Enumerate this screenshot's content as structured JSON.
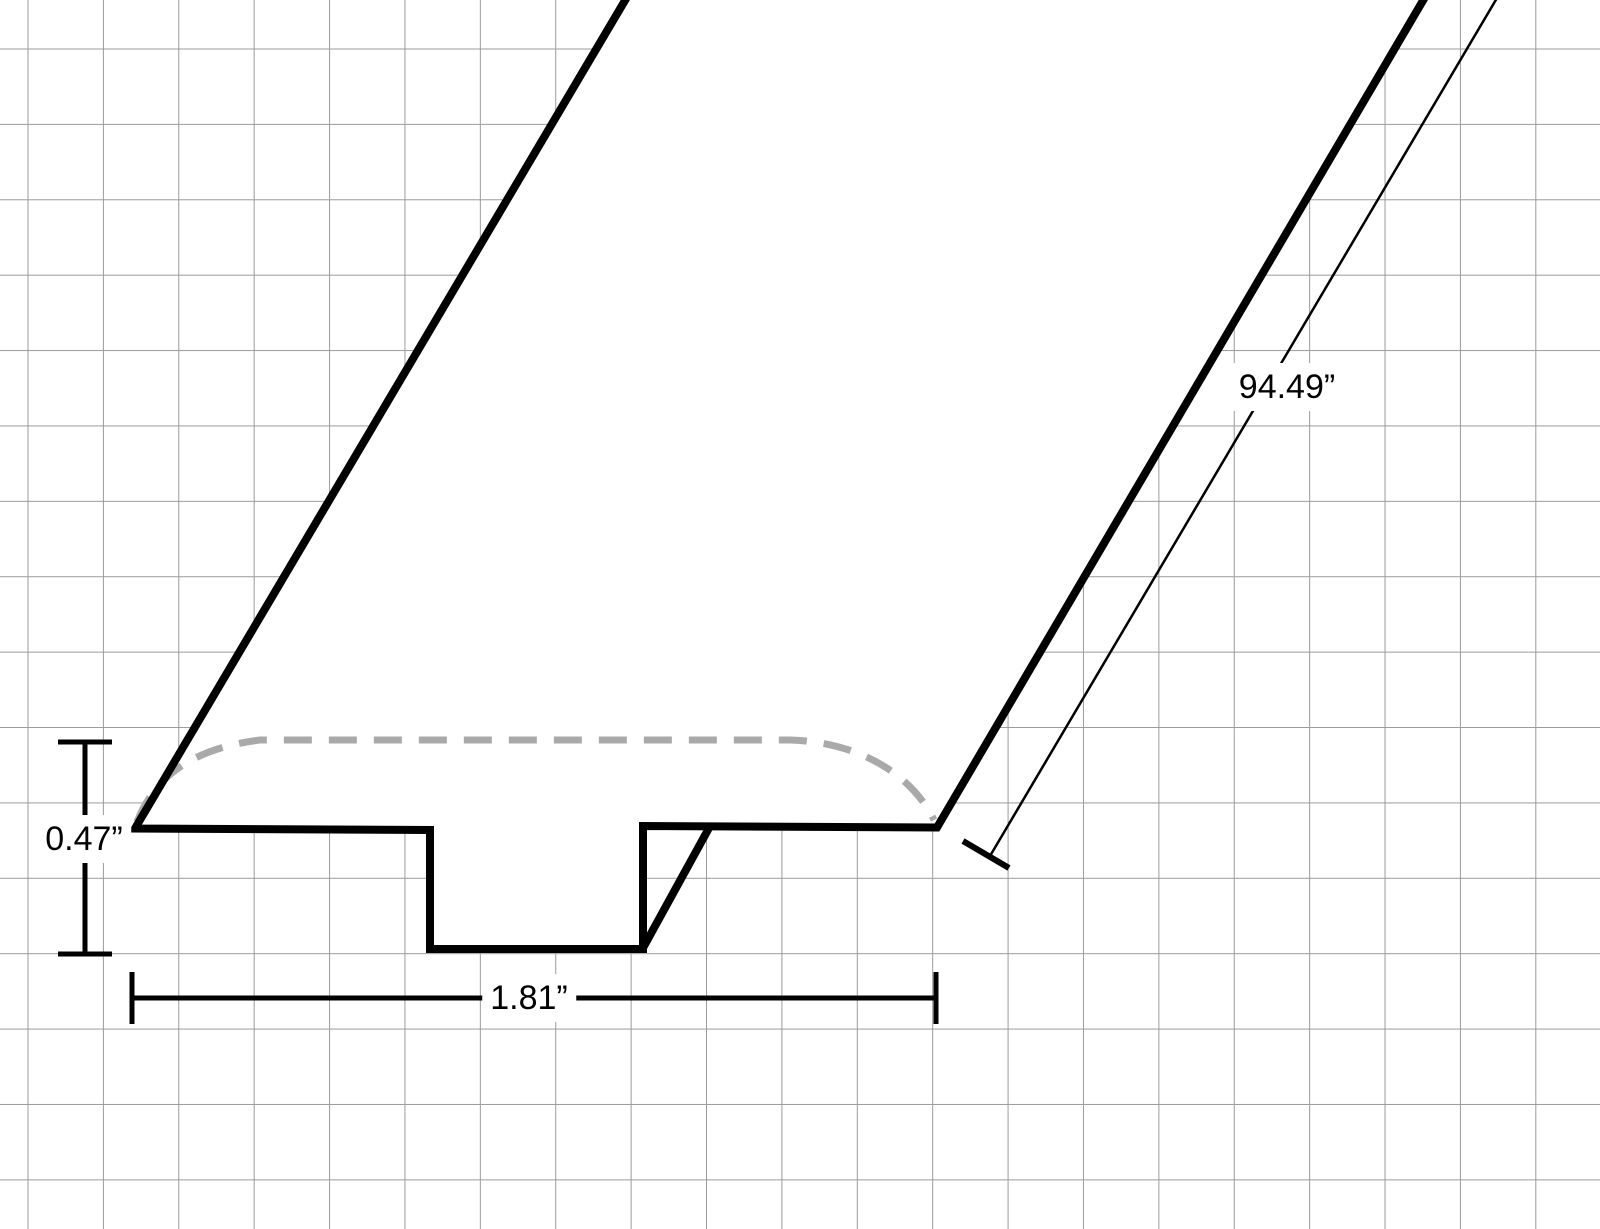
{
  "background_color": "#ffffff",
  "grid": {
    "color": "#9b9b9b",
    "spacing_px": 75.4,
    "offset_x_px": 27.5,
    "offset_y_px": 48.5
  },
  "drawing": {
    "stroke_color": "#000000",
    "hidden_line_color": "#a9a9a9",
    "fill_color": "#ffffff",
    "silhouette_path": "M 630 -8 L 135 828.5 L 430 830 L 430 949 L 643 949 L 643 826 L 937 827.5 L 1428 -8 Z",
    "outline_path": "M 630 -8 L 135 828.5 L 430 830 L 430 949 L 643 949 L 643 826 L 937 827.5 L 1428 -8",
    "notch_back_edge_path": "M 643 948 L 709 828",
    "hidden_top_curve_path": "M 137 822 C 155 775 195 748 260 740 L 790 740 C 860 742 912 775 934 820"
  },
  "dimensions": {
    "height": {
      "label": "0.47”",
      "line_path": "M 85 742 L 85 954",
      "start_cap_path": "M 58 742 L 112 742",
      "end_cap_path": "M 58 954 L 112 954"
    },
    "width": {
      "label": "1.81”",
      "line_path": "M 132 998 L 936 998",
      "start_cap_path": "M 132 972 L 132 1024",
      "end_cap_path": "M 936 972 L 936 1024"
    },
    "length": {
      "label": "94.49”",
      "line_path": "M 1497 -2 L 990 856",
      "end_tick_path": "M 963 841 L 1009 868"
    }
  }
}
